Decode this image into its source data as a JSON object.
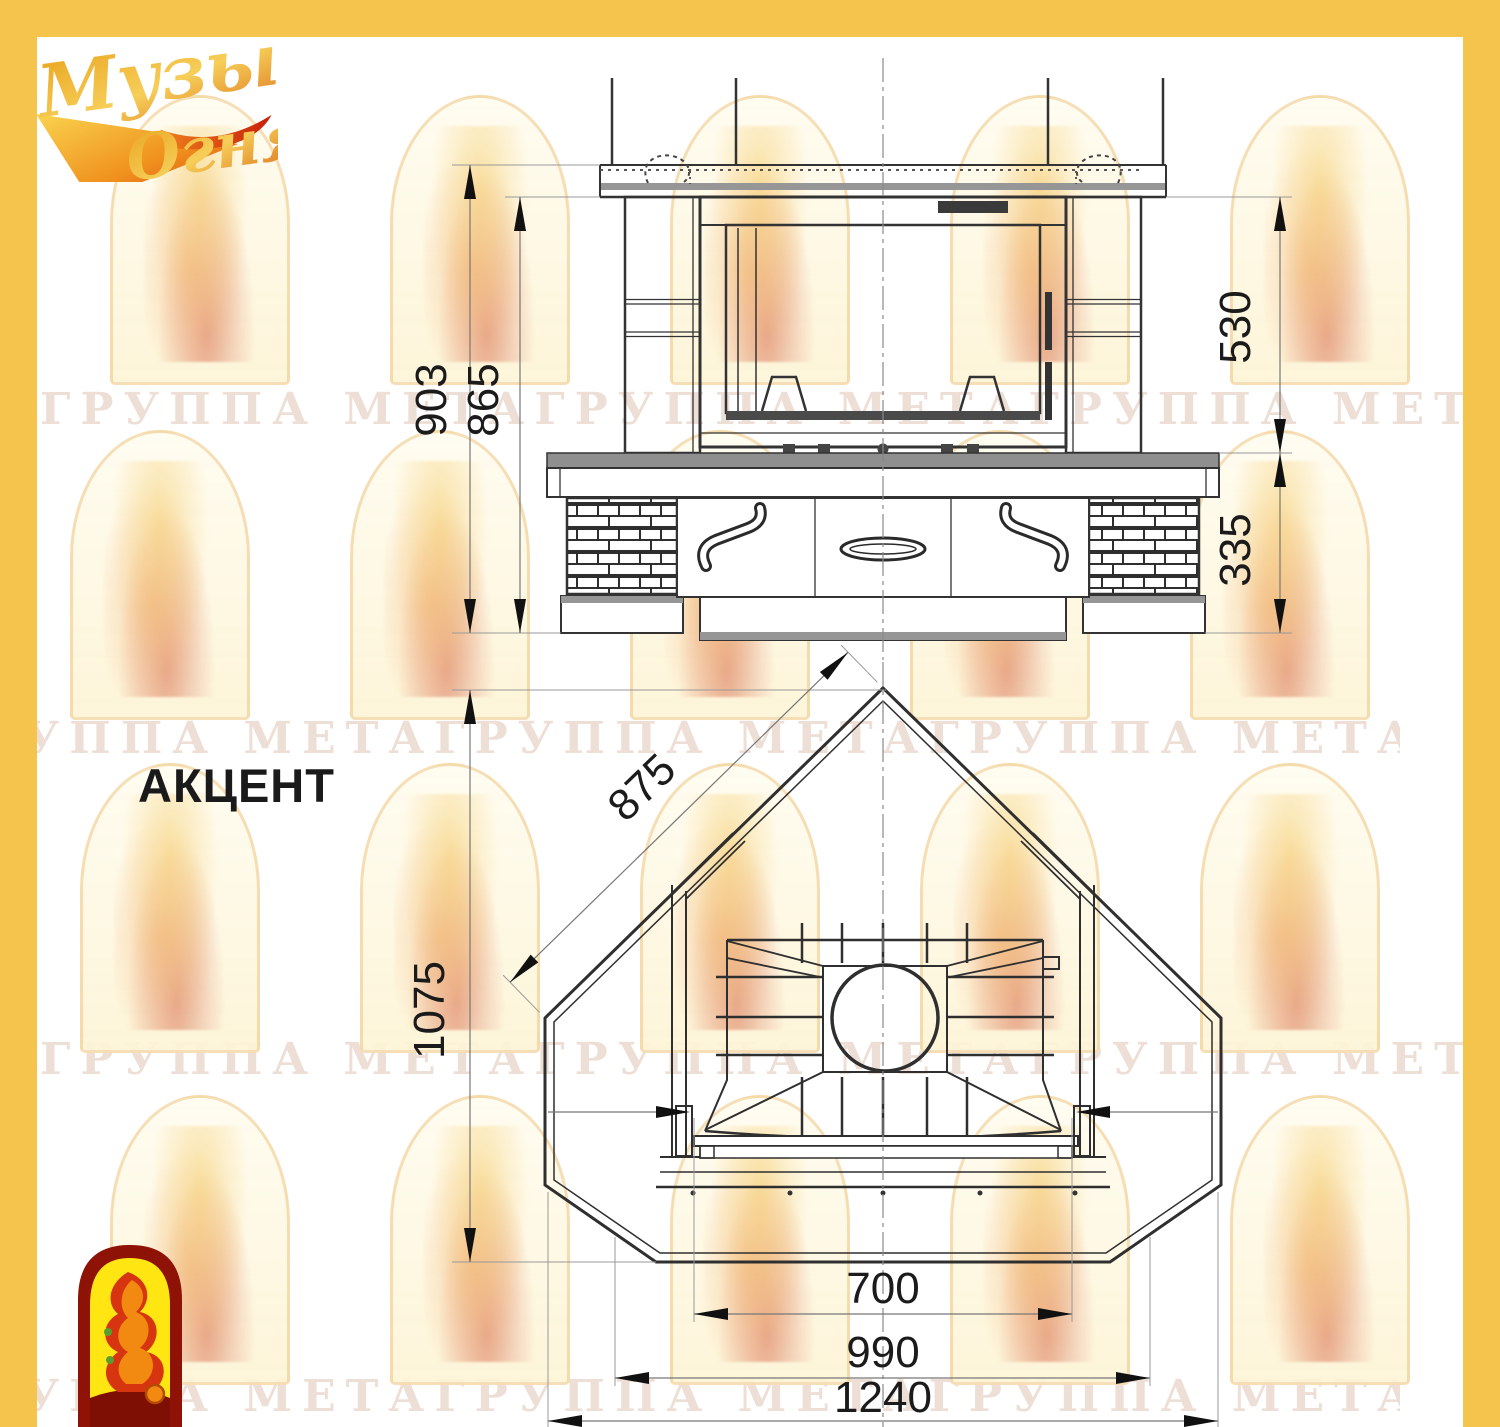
{
  "page": {
    "frame_yellow": "#f5c44d",
    "logo_dark_red": "#8e1205",
    "logo_yellow": "#ffe512"
  },
  "brand_logo": {
    "word1": "Музыка",
    "word2": "Огня"
  },
  "model_label": "АКЦЕНТ",
  "watermark": {
    "row_text": "ГРУППА МЕТАГРУППА МЕТАГРУППА МЕТАГРУППА МЕТА"
  },
  "front_view": {
    "dim_total_height": "903",
    "dim_shelf_height": "865",
    "dim_opening_height": "530",
    "dim_base_height": "335"
  },
  "plan_view": {
    "dim_diagonal_side": "875",
    "dim_depth": "1075",
    "dim_firebox_width": "700",
    "dim_bench_width": "990",
    "dim_overall_width": "1240"
  }
}
